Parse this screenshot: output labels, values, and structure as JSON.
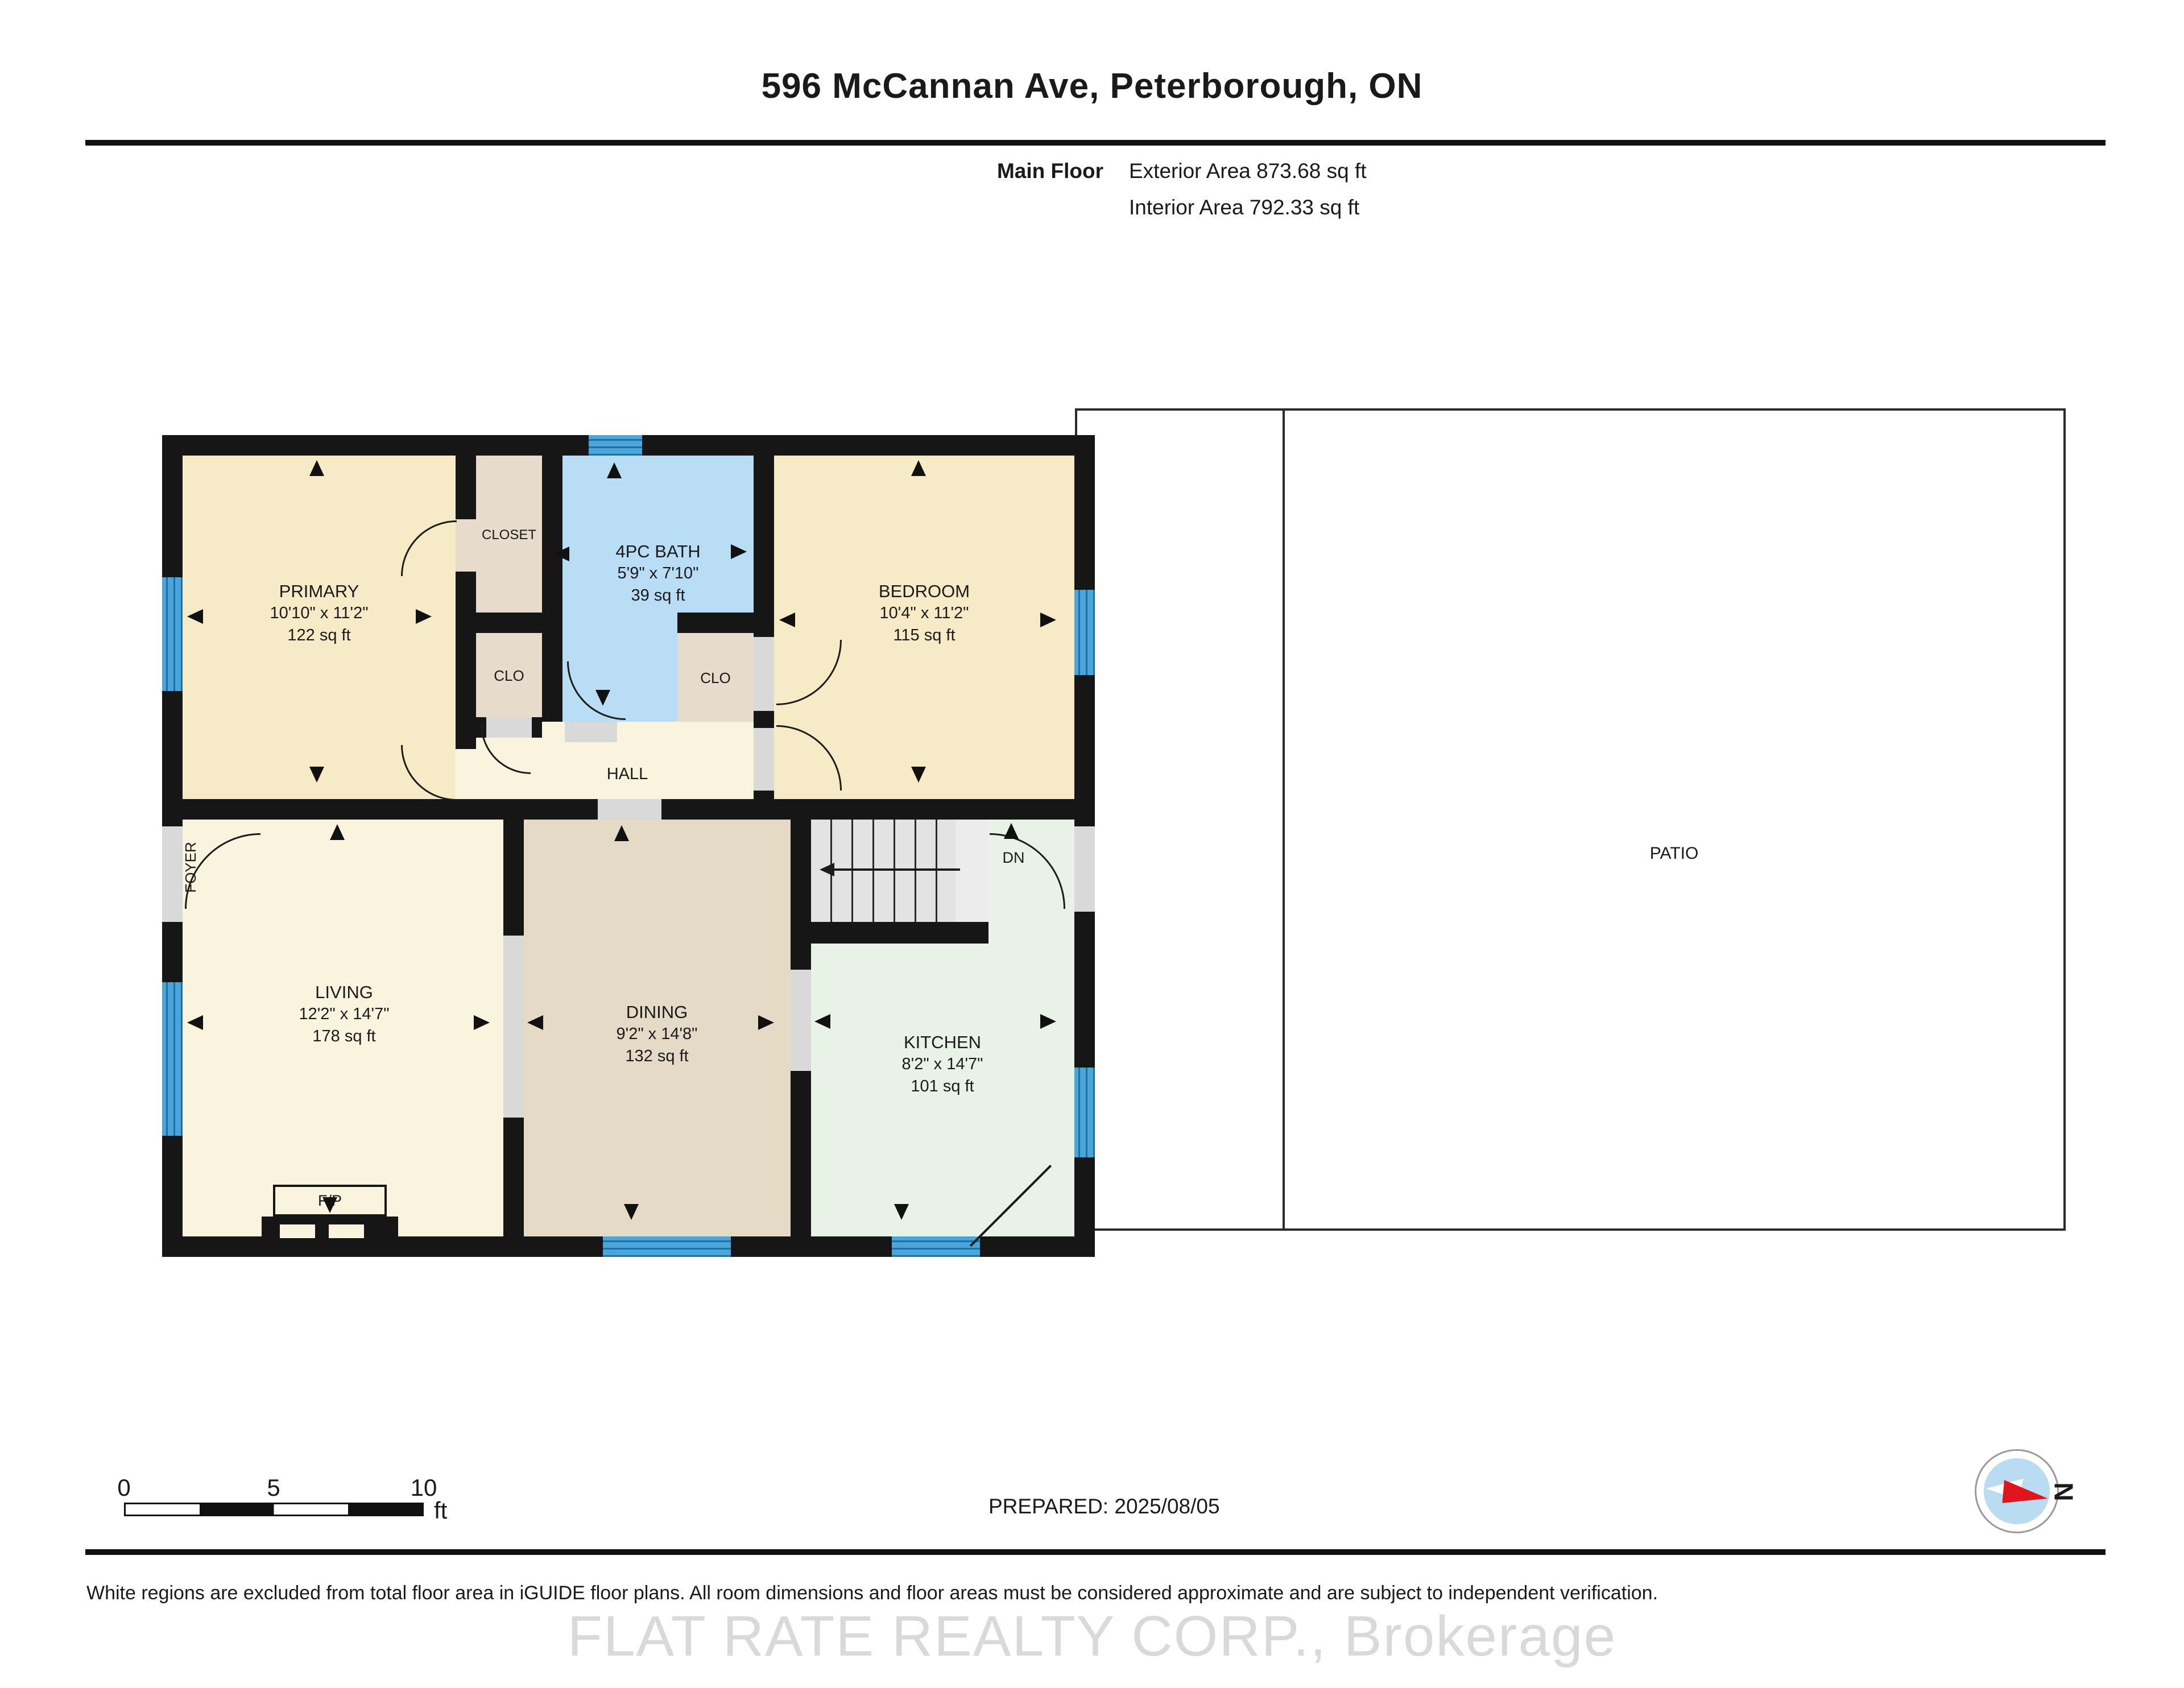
{
  "page": {
    "title": "596 McCannan Ave, Peterborough, ON"
  },
  "header": {
    "floor_name": "Main Floor",
    "exterior_area": "Exterior Area 873.68 sq ft",
    "interior_area": "Interior Area 792.33 sq ft"
  },
  "rooms": [
    {
      "id": "primary",
      "name": "PRIMARY",
      "dims": "10'10\" x 11'2\"",
      "area": "122 sq ft"
    },
    {
      "id": "bath",
      "name": "4PC BATH",
      "dims": "5'9\" x 7'10\"",
      "area": "39 sq ft"
    },
    {
      "id": "bedroom",
      "name": "BEDROOM",
      "dims": "10'4\" x 11'2\"",
      "area": "115 sq ft"
    },
    {
      "id": "living",
      "name": "LIVING",
      "dims": "12'2\" x 14'7\"",
      "area": "178 sq ft"
    },
    {
      "id": "dining",
      "name": "DINING",
      "dims": "9'2\" x 14'8\"",
      "area": "132 sq ft"
    },
    {
      "id": "kitchen",
      "name": "KITCHEN",
      "dims": "8'2\" x 14'7\"",
      "area": "101 sq ft"
    }
  ],
  "labels": {
    "closet": "CLOSET",
    "clo": "CLO",
    "hall": "HALL",
    "foyer": "FOYER",
    "fireplace": "F/P",
    "down": "DN",
    "patio": "PATIO"
  },
  "scale_bar": {
    "ticks": [
      "0",
      "5",
      "10"
    ],
    "unit": "ft"
  },
  "prepared": "PREPARED: 2025/08/05",
  "compass": {
    "north": "N"
  },
  "footer": {
    "disclaimer": "White regions are excluded from total floor area in iGUIDE floor plans. All room dimensions and floor areas must be considered approximate and are subject to independent verification.",
    "watermark": "FLAT RATE REALTY CORP., Brokerage"
  },
  "colors": {
    "wall": "#161616",
    "bedroom_fill": "#f7eac6",
    "living_fill": "#faf3dd",
    "closet_fill": "#e7dccb",
    "dining_fill": "#e4dac5",
    "kitchen_fill": "#e8f2e7",
    "bath_fill": "#b8ddf5",
    "window_blue": "#49a5da",
    "stairs_gray": "#e3e3e3",
    "needle_red": "#e1151c",
    "watermark_gray": "#d9d9d9"
  }
}
